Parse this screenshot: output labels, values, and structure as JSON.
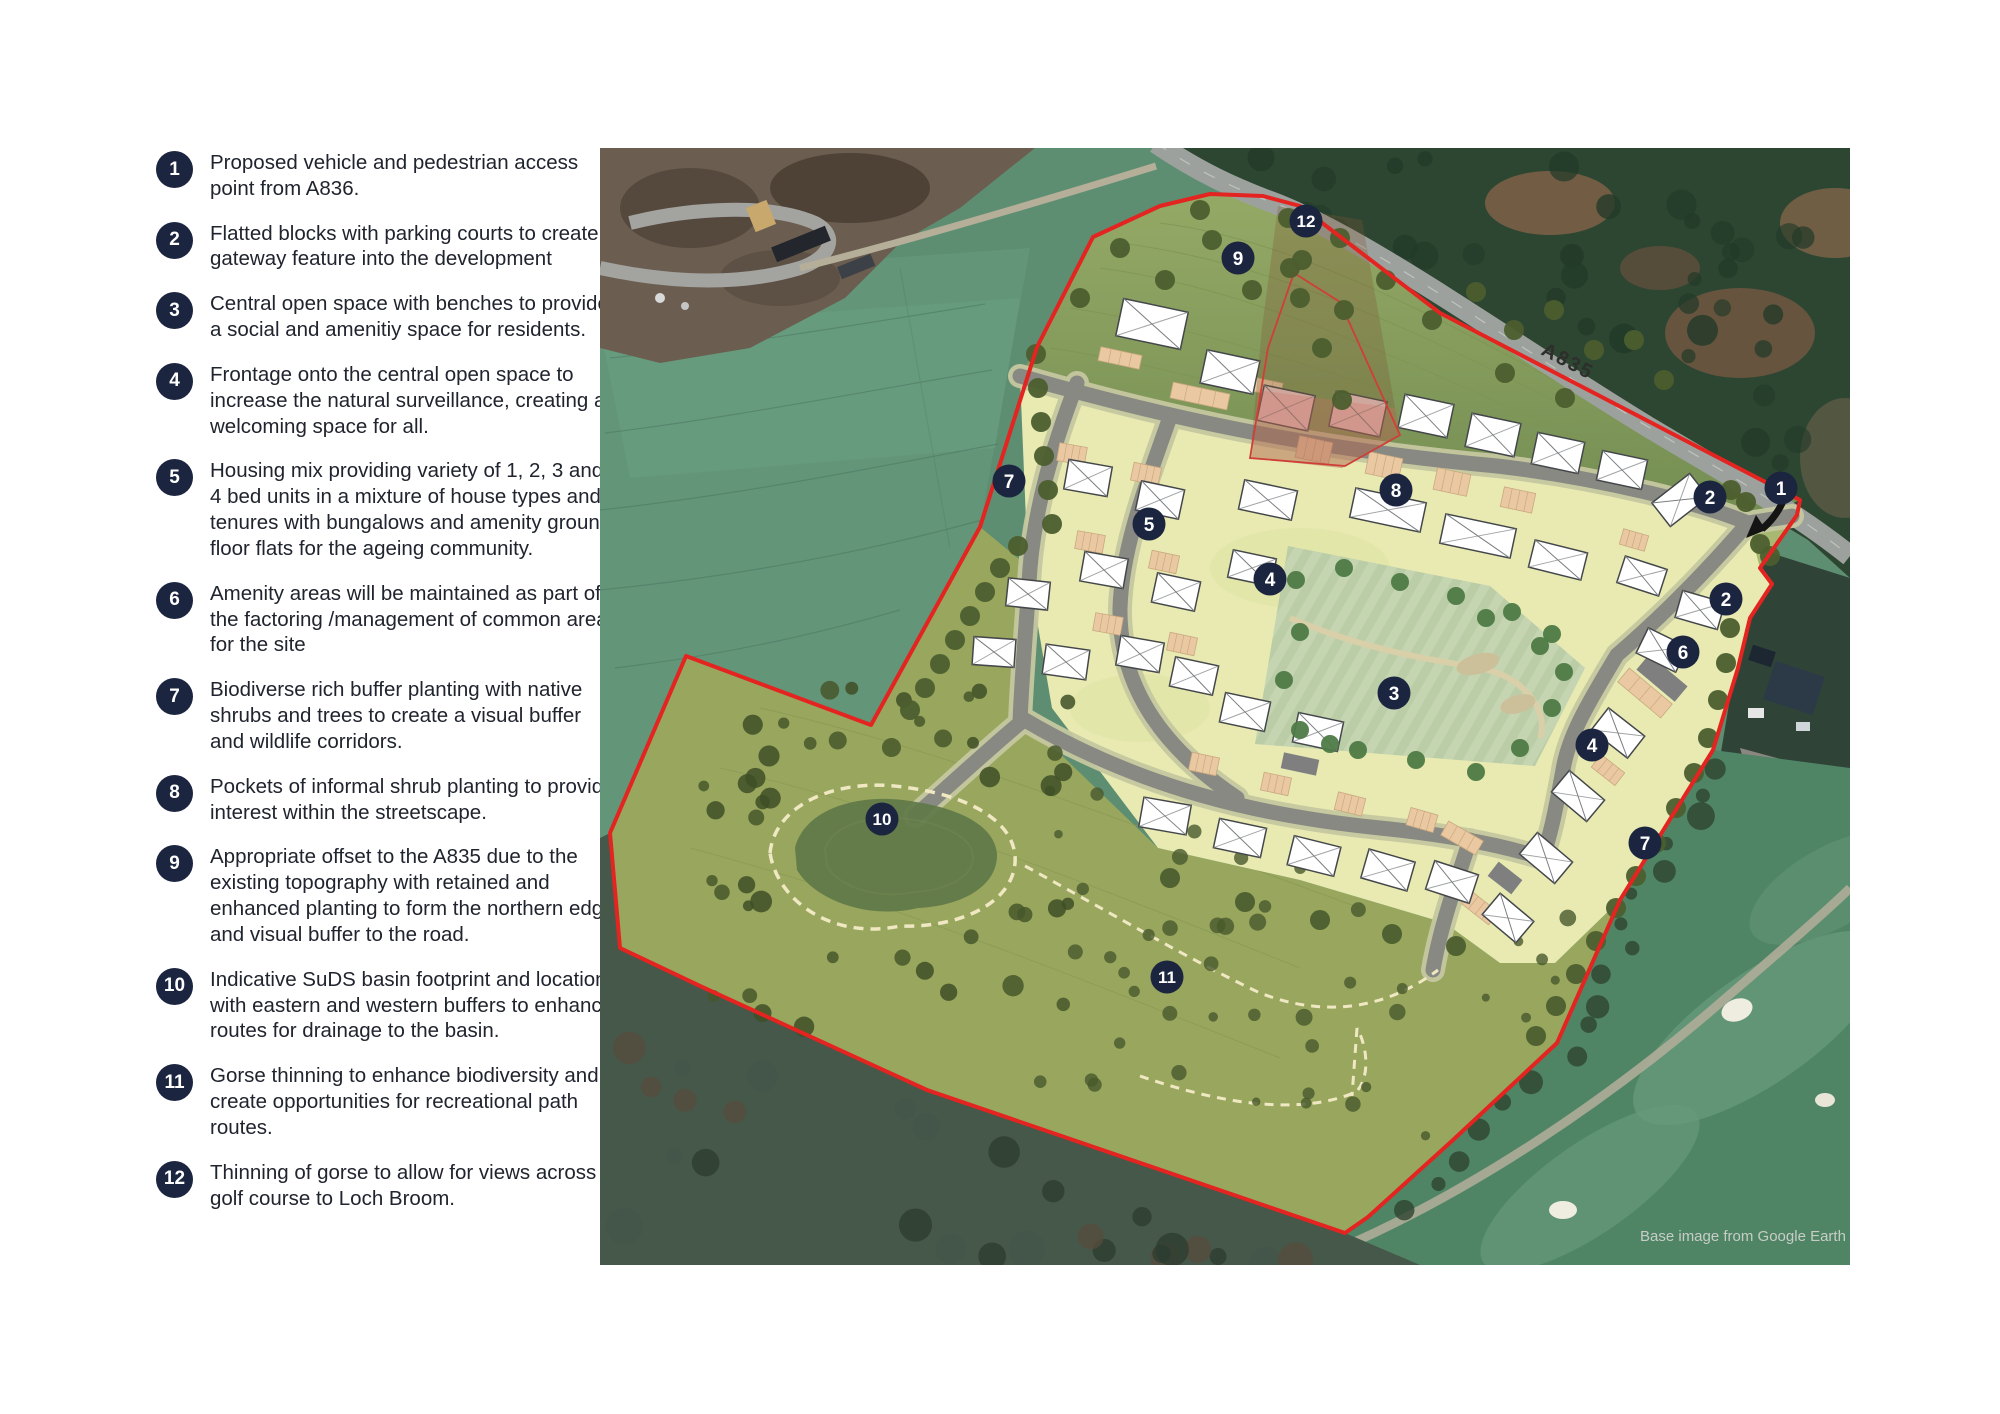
{
  "legend": {
    "items": [
      {
        "num": "1",
        "text": "Proposed vehicle and pedestrian access point from A836."
      },
      {
        "num": "2",
        "text": "Flatted blocks with parking courts to create a gateway feature into the development"
      },
      {
        "num": "3",
        "text": "Central open space with benches to provide a social and amenitiy space for residents."
      },
      {
        "num": "4",
        "text": "Frontage onto the central open space to increase the natural surveillance, creating a welcoming space for all."
      },
      {
        "num": "5",
        "text": "Housing mix providing variety of 1, 2, 3 and 4 bed units in a mixture of house types and tenures with bungalows and amenity ground floor flats for the ageing community."
      },
      {
        "num": "6",
        "text": "Amenity areas will be maintained as part of the factoring /management of common areas for the site"
      },
      {
        "num": "7",
        "text": "Biodiverse rich buffer planting with native shrubs and trees to create a visual buffer and wildlife corridors."
      },
      {
        "num": "8",
        "text": "Pockets of informal shrub planting to provide interest within the streetscape."
      },
      {
        "num": "9",
        "text": "Appropriate offset to the A835 due to the existing topography with retained and enhanced planting to form the northern edge and visual buffer to the road."
      },
      {
        "num": "10",
        "text": "Indicative SuDS basin footprint and location with eastern and western buffers to enhance routes for drainage to the basin."
      },
      {
        "num": "11",
        "text": "Gorse thinning to enhance biodiversity and create opportunities for recreational path routes."
      },
      {
        "num": "12",
        "text": "Thinning of gorse to allow for views across golf course to Loch Broom."
      }
    ]
  },
  "colors": {
    "badge-navy": "#1c2540",
    "boundary-red": "#e32420",
    "legend-text": "#20242e",
    "road-gray": "#878982",
    "road-casing": "#c6c8a0",
    "plot-yellow": "#e8eab2",
    "parking-peach": "#eac9a2",
    "flat-pink": "#f2c9c9",
    "house-white": "#ffffff",
    "house-outline": "#44474a",
    "tree-dark": "#4c5e2e",
    "tree-open": "#4e7a44",
    "dash-cream": "#efe8c2"
  },
  "map": {
    "road_label": "A835",
    "attribution": "Base image from Google Earth",
    "badges": [
      {
        "n": "12",
        "x": 706,
        "y": 73
      },
      {
        "n": "9",
        "x": 638,
        "y": 110
      },
      {
        "n": "7",
        "x": 409,
        "y": 333
      },
      {
        "n": "5",
        "x": 549,
        "y": 376
      },
      {
        "n": "8",
        "x": 796,
        "y": 342
      },
      {
        "n": "2",
        "x": 1110,
        "y": 349
      },
      {
        "n": "1",
        "x": 1181,
        "y": 340
      },
      {
        "n": "4",
        "x": 670,
        "y": 431
      },
      {
        "n": "2",
        "x": 1126,
        "y": 451
      },
      {
        "n": "6",
        "x": 1083,
        "y": 504
      },
      {
        "n": "3",
        "x": 794,
        "y": 545
      },
      {
        "n": "4",
        "x": 992,
        "y": 597
      },
      {
        "n": "10",
        "x": 282,
        "y": 671
      },
      {
        "n": "7",
        "x": 1045,
        "y": 695
      },
      {
        "n": "11",
        "x": 567,
        "y": 829
      }
    ],
    "houses": [
      [
        552,
        176,
        66,
        38,
        12
      ],
      [
        630,
        224,
        54,
        34,
        12
      ],
      [
        826,
        268,
        50,
        34,
        12
      ],
      [
        893,
        287,
        50,
        34,
        12
      ],
      [
        958,
        305,
        48,
        32,
        12
      ],
      [
        1022,
        322,
        46,
        30,
        12
      ],
      [
        1080,
        352,
        48,
        30,
        -38
      ],
      [
        1100,
        462,
        44,
        28,
        16
      ],
      [
        788,
        362,
        72,
        30,
        12
      ],
      [
        878,
        388,
        72,
        30,
        12
      ],
      [
        958,
        412,
        54,
        28,
        14
      ],
      [
        668,
        352,
        54,
        30,
        12
      ],
      [
        652,
        420,
        44,
        28,
        12
      ],
      [
        488,
        330,
        44,
        30,
        10
      ],
      [
        560,
        352,
        44,
        30,
        12
      ],
      [
        504,
        422,
        44,
        30,
        10
      ],
      [
        576,
        444,
        44,
        30,
        12
      ],
      [
        428,
        446,
        42,
        28,
        6
      ],
      [
        394,
        504,
        42,
        28,
        4
      ],
      [
        466,
        514,
        44,
        30,
        8
      ],
      [
        540,
        506,
        44,
        30,
        10
      ],
      [
        594,
        528,
        44,
        30,
        12
      ],
      [
        645,
        564,
        46,
        30,
        12
      ],
      [
        718,
        584,
        46,
        30,
        12
      ],
      [
        565,
        668,
        48,
        30,
        10
      ],
      [
        640,
        690,
        48,
        30,
        12
      ],
      [
        714,
        708,
        48,
        30,
        14
      ],
      [
        788,
        722,
        48,
        30,
        16
      ],
      [
        852,
        734,
        46,
        30,
        18
      ],
      [
        1042,
        428,
        44,
        28,
        18
      ],
      [
        1062,
        502,
        44,
        28,
        26
      ],
      [
        1018,
        585,
        46,
        28,
        38
      ],
      [
        978,
        648,
        46,
        28,
        40
      ],
      [
        946,
        710,
        46,
        28,
        40
      ],
      [
        908,
        770,
        44,
        28,
        40
      ]
    ],
    "flats": [
      [
        686,
        260,
        52,
        36,
        12
      ],
      [
        758,
        266,
        52,
        36,
        12
      ]
    ],
    "parking": [
      [
        520,
        210,
        42,
        14,
        12
      ],
      [
        600,
        248,
        58,
        16,
        12
      ],
      [
        662,
        238,
        40,
        14,
        12
      ],
      [
        714,
        302,
        34,
        22,
        12
      ],
      [
        784,
        318,
        34,
        22,
        12
      ],
      [
        852,
        334,
        34,
        22,
        12
      ],
      [
        918,
        352,
        32,
        20,
        12
      ],
      [
        472,
        306,
        28,
        18,
        10
      ],
      [
        546,
        326,
        28,
        18,
        12
      ],
      [
        490,
        394,
        28,
        18,
        10
      ],
      [
        564,
        414,
        28,
        18,
        12
      ],
      [
        508,
        476,
        28,
        18,
        10
      ],
      [
        582,
        496,
        28,
        18,
        12
      ],
      [
        604,
        616,
        28,
        18,
        12
      ],
      [
        676,
        636,
        28,
        18,
        12
      ],
      [
        750,
        656,
        28,
        18,
        14
      ],
      [
        822,
        672,
        28,
        18,
        16
      ],
      [
        1034,
        392,
        26,
        16,
        16
      ],
      [
        1045,
        545,
        56,
        18,
        40
      ],
      [
        1008,
        622,
        30,
        16,
        38
      ],
      [
        862,
        690,
        40,
        16,
        30
      ],
      [
        880,
        760,
        34,
        16,
        38
      ]
    ],
    "pads": [
      [
        1062,
        530,
        50,
        20,
        40
      ],
      [
        700,
        616,
        36,
        16,
        12
      ],
      [
        905,
        730,
        30,
        18,
        38
      ]
    ],
    "trees_buffer": [
      [
        436,
        206
      ],
      [
        438,
        240
      ],
      [
        441,
        274
      ],
      [
        444,
        308
      ],
      [
        448,
        342
      ],
      [
        452,
        376
      ],
      [
        418,
        398
      ],
      [
        400,
        420
      ],
      [
        385,
        444
      ],
      [
        370,
        468
      ],
      [
        355,
        492
      ],
      [
        340,
        516
      ],
      [
        325,
        540
      ],
      [
        310,
        562
      ],
      [
        520,
        100
      ],
      [
        565,
        132
      ],
      [
        612,
        92
      ],
      [
        652,
        142
      ],
      [
        702,
        112
      ],
      [
        744,
        162
      ],
      [
        786,
        132
      ],
      [
        832,
        172
      ],
      [
        876,
        144
      ],
      [
        914,
        182
      ],
      [
        954,
        162
      ],
      [
        994,
        202
      ],
      [
        1034,
        192
      ],
      [
        1064,
        232
      ],
      [
        688,
        70
      ],
      [
        600,
        62
      ],
      [
        480,
        150
      ],
      [
        740,
        90
      ],
      [
        905,
        225
      ],
      [
        965,
        250
      ],
      [
        700,
        150
      ],
      [
        722,
        200
      ],
      [
        742,
        252
      ],
      [
        690,
        120
      ],
      [
        1131,
        342
      ],
      [
        1146,
        354
      ],
      [
        1160,
        396
      ],
      [
        1170,
        408
      ],
      [
        1124,
        445
      ],
      [
        1130,
        480
      ],
      [
        1126,
        515
      ],
      [
        1118,
        552
      ],
      [
        1108,
        590
      ],
      [
        1094,
        625
      ],
      [
        1076,
        660
      ],
      [
        1056,
        695
      ],
      [
        1036,
        728
      ],
      [
        1016,
        760
      ],
      [
        996,
        793
      ],
      [
        976,
        826
      ],
      [
        956,
        858
      ],
      [
        936,
        888
      ],
      [
        570,
        730
      ],
      [
        645,
        754
      ],
      [
        720,
        772
      ],
      [
        792,
        786
      ],
      [
        856,
        798
      ]
    ],
    "trees_open": [
      [
        696,
        432
      ],
      [
        744,
        420
      ],
      [
        800,
        434
      ],
      [
        856,
        448
      ],
      [
        912,
        464
      ],
      [
        952,
        486
      ],
      [
        700,
        484
      ],
      [
        684,
        532
      ],
      [
        700,
        582
      ],
      [
        758,
        602
      ],
      [
        816,
        612
      ],
      [
        876,
        624
      ],
      [
        920,
        600
      ],
      [
        952,
        560
      ],
      [
        964,
        524
      ],
      [
        940,
        498
      ],
      [
        730,
        596
      ],
      [
        886,
        470
      ]
    ]
  }
}
